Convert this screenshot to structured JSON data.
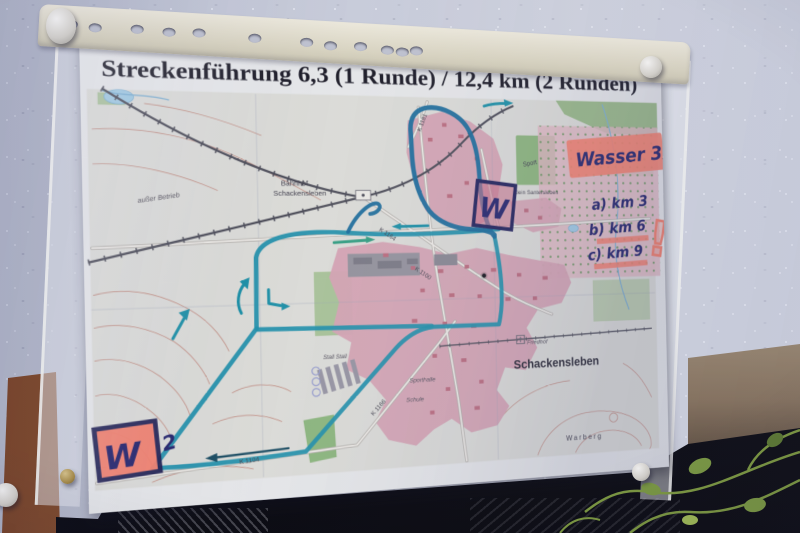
{
  "poster": {
    "title": "Streckenführung 6,3 (1 Runde) / 12,4 km (2 Runden)"
  },
  "handwritten": {
    "water_note": "Wasser 3x",
    "water_km_a": "a) km 3",
    "water_km_b": "b) km 6",
    "water_km_c": "c) km 9",
    "exclamation": "!",
    "water_station_letter": "W",
    "loop_count": "2"
  },
  "map_labels": {
    "bahnhof_line1": "Bahnhof",
    "bahnhof_line2": "Schackensleben",
    "ausser_betrieb": "außer Betrieb",
    "klein_santersleben": "Klein Santersleben",
    "sport": "Sport",
    "friedhof": "Friedhof",
    "town": "Schackensleben",
    "warberg": "Warberg",
    "schule": "Schule",
    "sporthalle": "Sporthalle",
    "stall": "Stall Stall",
    "road_k1104": "K 1104",
    "road_k1166": "K 1166",
    "road_k1164": "K 1164",
    "road_k1100": "K 1100",
    "road_k1181": "K 1181"
  },
  "colors": {
    "route_teal": "#2293ac",
    "route_dark": "#1d6f9d",
    "marker_ink": "#28286e",
    "highlighter_pink": "#f8836e",
    "village_pink": "#d9a7b5",
    "field_green": "#a3c28e"
  }
}
